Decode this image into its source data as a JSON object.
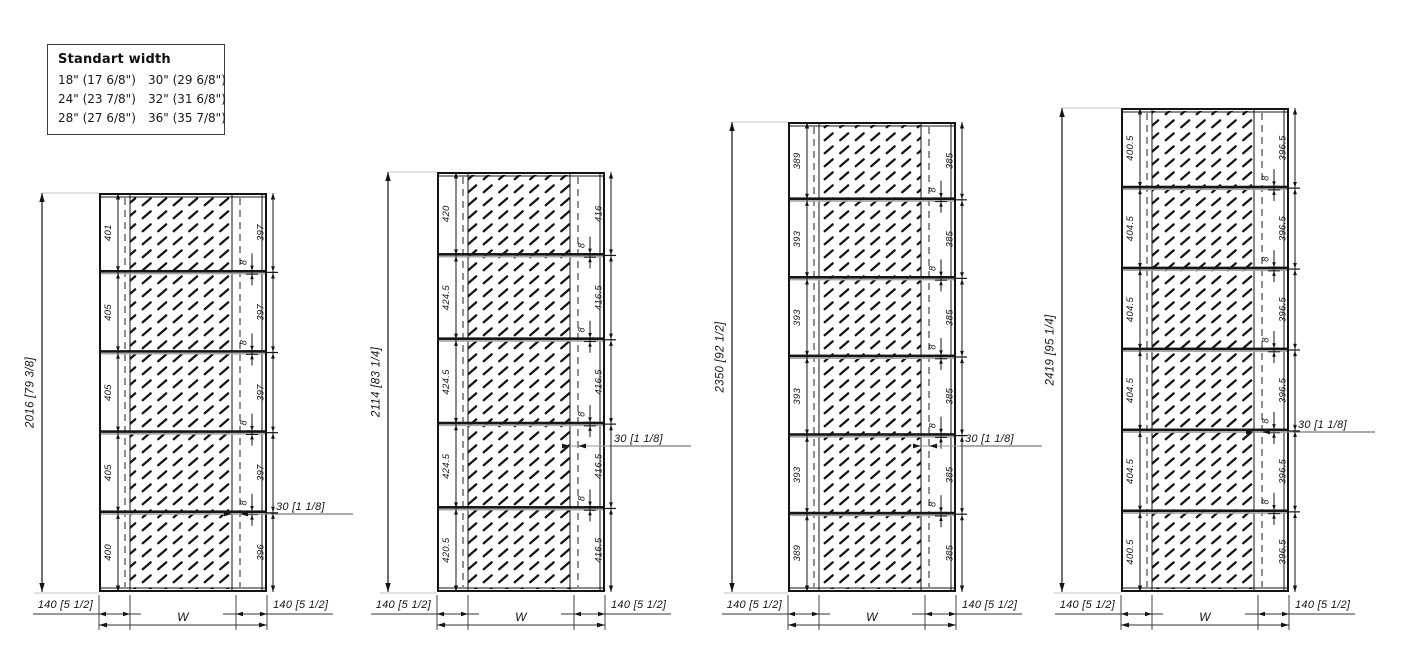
{
  "legend": {
    "title": "Standart width",
    "entries": [
      [
        "18\" (17 6/8\")",
        "30\" (29 6/8\")"
      ],
      [
        "24\" (23 7/8\")",
        "32\" (31 6/8\")"
      ],
      [
        "28\" (27 6/8\")",
        "36\" (35 7/8\")"
      ]
    ]
  },
  "shared_labels": {
    "stile_width": "140 [5 1/2]",
    "width_symbol": "W",
    "lock_offset": "30 [1 1/8]",
    "gap": "8"
  },
  "colors": {
    "line": "#141414",
    "rail_shadow": "#a8a8a8",
    "extension_gray": "#c6c6c6",
    "leader_gray": "#9a9a9a",
    "background": "#ffffff"
  },
  "panels": [
    {
      "overall_height": "2016 [79 3/8]",
      "left_section_heights": [
        "401",
        "405",
        "405",
        "405",
        "400"
      ],
      "right_section_heights": [
        "397",
        "397",
        "397",
        "397",
        "396"
      ]
    },
    {
      "overall_height": "2114 [83 1/4]",
      "left_section_heights": [
        "420",
        "424.5",
        "424.5",
        "424.5",
        "420.5"
      ],
      "right_section_heights": [
        "416",
        "416.5",
        "416.5",
        "416.5",
        "416.5"
      ]
    },
    {
      "overall_height": "2350 [92 1/2]",
      "left_section_heights": [
        "389",
        "393",
        "393",
        "393",
        "393",
        "389"
      ],
      "right_section_heights": [
        "385",
        "385",
        "385",
        "385",
        "385",
        "385"
      ]
    },
    {
      "overall_height": "2419 [95 1/4]",
      "left_section_heights": [
        "400.5",
        "404.5",
        "404.5",
        "404.5",
        "404.5",
        "400.5"
      ],
      "right_section_heights": [
        "396.5",
        "396.5",
        "396.5",
        "396.5",
        "396.5",
        "396.5"
      ]
    }
  ]
}
